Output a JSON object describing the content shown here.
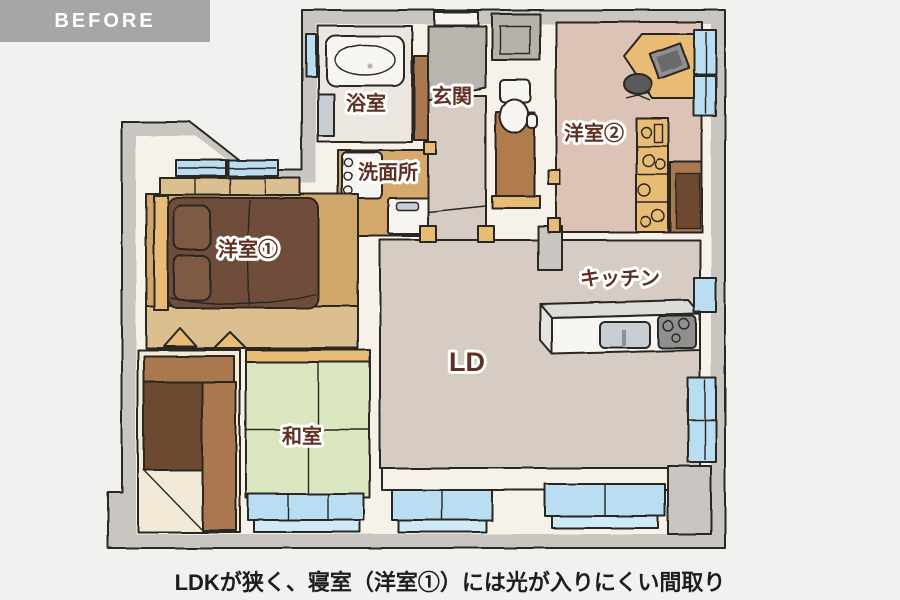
{
  "header": {
    "before_label": "BEFORE"
  },
  "caption": "LDKが狭く、寝室（洋室①）には光が入りにくい間取り",
  "floorplan": {
    "rooms": {
      "bathroom": {
        "label": "浴室"
      },
      "entrance": {
        "label": "玄関"
      },
      "washroom": {
        "label": "洗面所"
      },
      "bedroom1": {
        "label": "洋室①"
      },
      "bedroom2": {
        "label": "洋室②"
      },
      "kitchen": {
        "label": "キッチン"
      },
      "living_dining": {
        "label": "LD"
      },
      "japanese_room": {
        "label": "和室"
      }
    },
    "colors": {
      "page_bg": "#f1f1ef",
      "before_bg": "#a6a6a6",
      "before_text": "#ffffff",
      "caption_text": "#1d1d1d",
      "outline": "#2a2520",
      "wall_gray": "#c9c6c2",
      "inner_cream": "#f6f2ea",
      "window_blue": "#b9def1",
      "window_blue_light": "#cfeaf7",
      "label_brown": "#5f3122",
      "bathroom_floor": "#ebe6df",
      "washroom_floor": "#d5a96c",
      "entrance_tile": "#b9b4ae",
      "bedroom1_floor": "#d0a76b",
      "bedroom1_floor_light": "#dcbf8e",
      "bedroom2_floor": "#dcc3b5",
      "tatami_green": "#d9e6c0",
      "ld_floor": "#d6ccc3",
      "toilet_floor": "#b07c4e",
      "wood_trim": "#e8bc74",
      "closet_brown": "#a9784f",
      "closet_dark": "#6e4a33",
      "bed_dark": "#6f4d3a",
      "bed_mid": "#7e5a45",
      "furniture_white": "#f7f5f1",
      "appliance_gray": "#c7cdd4",
      "counter_gray": "#dcdcda",
      "stove_gray": "#8f8f8f"
    }
  }
}
